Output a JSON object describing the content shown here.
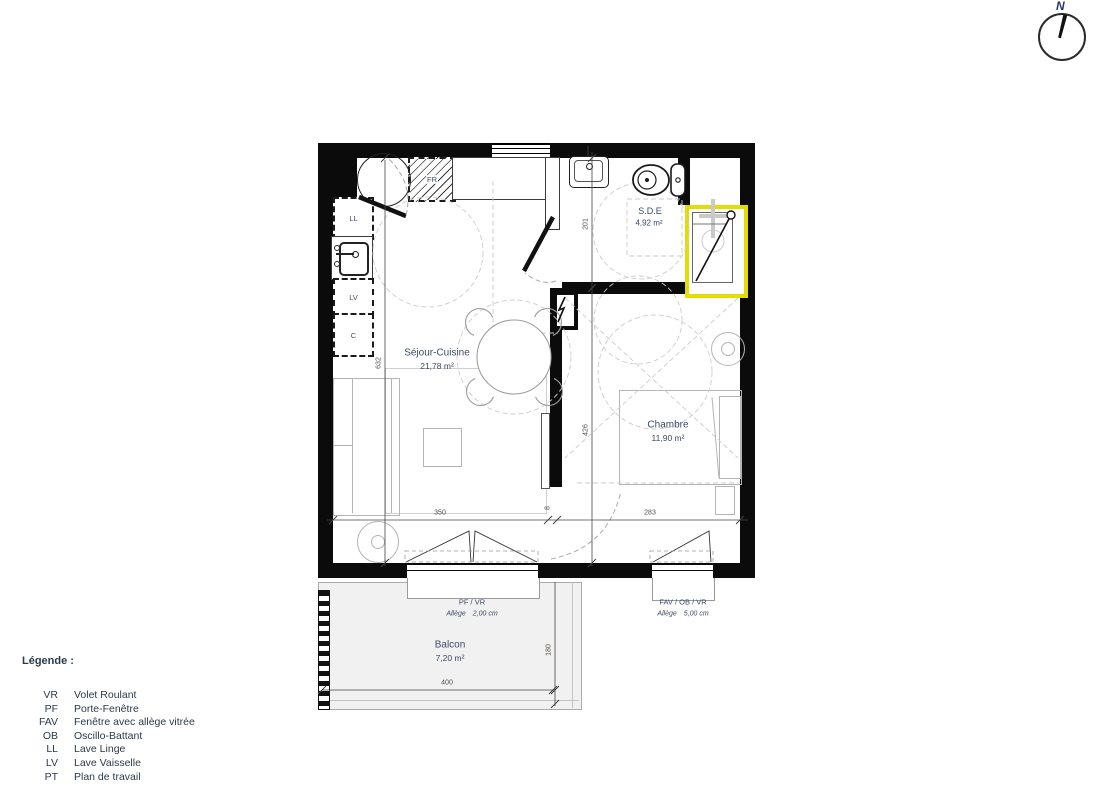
{
  "north": {
    "label": "N"
  },
  "plan": {
    "rooms": {
      "sejour": {
        "name": "Séjour-Cuisine",
        "area": "21,78 m²"
      },
      "chambre": {
        "name": "Chambre",
        "area": "11,90 m²"
      },
      "sde": {
        "name": "S.D.E",
        "area": "4,92 m²"
      },
      "balcon": {
        "name": "Balcon",
        "area": "7,20 m²"
      }
    },
    "appliances": {
      "fridge": "FR",
      "washer": "LL",
      "dishwasher": "LV",
      "closet": "C"
    },
    "openings": {
      "pf": {
        "label": "PF / VR",
        "allege": "Allège",
        "value": "2,00 cm"
      },
      "fav": {
        "label": "FAV / OB / VR",
        "allege": "Allège",
        "value": "5,00 cm"
      }
    },
    "dimensions": {
      "sejour_width": "350",
      "chambre_width": "283",
      "wall": "8",
      "total_depth": "632",
      "sde_depth": "201",
      "chambre_depth": "426",
      "balcon_width": "400",
      "balcon_depth": "180"
    },
    "colors": {
      "shower_highlight": "#e4de00"
    }
  },
  "legend": {
    "title": "Légende :",
    "items": [
      {
        "abbr": "VR",
        "label": "Volet Roulant"
      },
      {
        "abbr": "PF",
        "label": "Porte-Fenêtre"
      },
      {
        "abbr": "FAV",
        "label": "Fenêtre avec allège vitrée"
      },
      {
        "abbr": "OB",
        "label": "Oscillo-Battant"
      },
      {
        "abbr": "LL",
        "label": "Lave Linge"
      },
      {
        "abbr": "LV",
        "label": "Lave Vaisselle"
      },
      {
        "abbr": "PT",
        "label": "Plan de travail"
      }
    ]
  }
}
